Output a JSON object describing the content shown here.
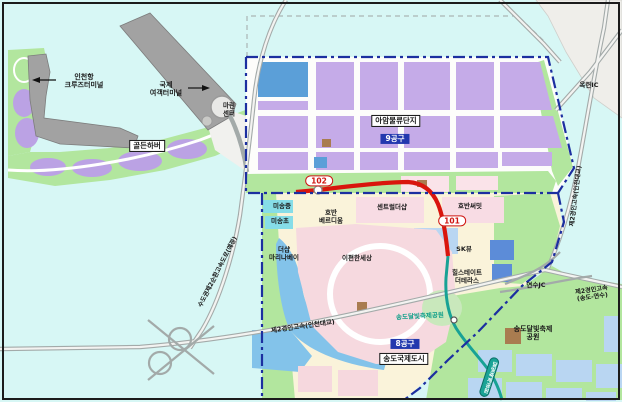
{
  "map_title": "송도국제도시 일대 안내도",
  "regions": {
    "district9_badge": "9공구",
    "district8_badge": "8공구",
    "logistics_complex": "아암물류단지",
    "city_box": "송도국제도시"
  },
  "rail": {
    "station_101": "101",
    "station_102": "102",
    "station_pill": "달빛축제공원",
    "line_color": "#d9150d",
    "subway_color": "#18a295"
  },
  "colors": {
    "water": "#d7f7f5",
    "green_land": "#b2e69e",
    "purple_block": "#c5abe8",
    "blue_block": "#5b9fd8",
    "lightblue_block": "#b9d6f2",
    "pink_block": "#f8dce4",
    "cream_land": "#faf3da",
    "canal": "#83c3ea",
    "boundary_navy": "#1c2fa0",
    "badge_blue": "#2238ae",
    "route_red": "#cf1612",
    "building_gray": "#a2a2a2"
  },
  "labels": [
    {
      "name": "label-incheon-cruise-terminal",
      "text": "인천항\n크루즈터미널",
      "x": 84,
      "y": 81,
      "cls": "plain"
    },
    {
      "name": "label-intl-passenger-terminal",
      "text": "국제\n여객터미널",
      "x": 166,
      "y": 89,
      "cls": "plain"
    },
    {
      "name": "label-marine-center",
      "text": "마린\n센터",
      "x": 229,
      "y": 110,
      "cls": "small"
    },
    {
      "name": "label-golden-harbor",
      "text": "골든하버",
      "x": 147,
      "y": 146,
      "cls": "box"
    },
    {
      "name": "label-aam-logistics-complex",
      "text": "아암물류단지",
      "x": 396,
      "y": 121,
      "cls": "box"
    },
    {
      "name": "badge-district-9",
      "text": "9공구",
      "x": 395,
      "y": 139,
      "cls": "badge-blue"
    },
    {
      "name": "badge-station-102",
      "text": "102",
      "x": 319,
      "y": 181,
      "cls": "route"
    },
    {
      "name": "badge-station-101",
      "text": "101",
      "x": 452,
      "y": 221,
      "cls": "route"
    },
    {
      "name": "label-okryeon-ic",
      "text": "옥련IC",
      "x": 589,
      "y": 86,
      "cls": "small"
    },
    {
      "name": "label-expwy-incheon-bridge-vertical",
      "text": "제2경인고속(인천대교)",
      "x": 576,
      "y": 196,
      "cls": "tiny",
      "rot": -83
    },
    {
      "name": "label-misong-middle-school",
      "text": "미송중",
      "x": 282,
      "y": 207,
      "cls": "small"
    },
    {
      "name": "label-misong-elementary-school",
      "text": "미송초",
      "x": 280,
      "y": 222,
      "cls": "small"
    },
    {
      "name": "label-hoban-verdium",
      "text": "호반\n베르디움",
      "x": 331,
      "y": 217,
      "cls": "small"
    },
    {
      "name": "label-central-thesharp",
      "text": "센트럴더샵",
      "x": 392,
      "y": 208,
      "cls": "small"
    },
    {
      "name": "label-hoban-summit",
      "text": "호반써밋",
      "x": 470,
      "y": 207,
      "cls": "small"
    },
    {
      "name": "label-sk-view",
      "text": "SK뷰",
      "x": 464,
      "y": 250,
      "cls": "small"
    },
    {
      "name": "label-thesharp-marina-bay",
      "text": "더샵\n마리나베이",
      "x": 284,
      "y": 254,
      "cls": "small"
    },
    {
      "name": "label-epyeonhan-sesang",
      "text": "이편한세상",
      "x": 357,
      "y": 259,
      "cls": "small"
    },
    {
      "name": "label-hillstate-the-terrace",
      "text": "힐스테이트\n더테라스",
      "x": 467,
      "y": 277,
      "cls": "small"
    },
    {
      "name": "label-yeonsu-jc",
      "text": "연수JC",
      "x": 536,
      "y": 286,
      "cls": "small"
    },
    {
      "name": "label-expwy-songdo-yeonsu",
      "text": "제2경인고속\n(송도-연수)",
      "x": 592,
      "y": 294,
      "cls": "tiny",
      "rot": -8
    },
    {
      "name": "label-expwy-incheon-bridge",
      "text": "제2경인고속(인천대교)",
      "x": 303,
      "y": 327,
      "cls": "small",
      "rot": -8
    },
    {
      "name": "label-songdo-moonlight-park-road",
      "text": "송도달빛축제공원",
      "x": 420,
      "y": 317,
      "cls": "green",
      "rot": -3
    },
    {
      "name": "badge-district-8",
      "text": "8공구",
      "x": 405,
      "y": 344,
      "cls": "badge-blue"
    },
    {
      "name": "label-songdo-international-city",
      "text": "송도국제도시",
      "x": 404,
      "y": 359,
      "cls": "box"
    },
    {
      "name": "label-songdo-moonlight-festival-park",
      "text": "송도달빛축제\n공원",
      "x": 533,
      "y": 333,
      "cls": "plain"
    },
    {
      "name": "label-expwy-2nd-ring-planned",
      "text": "수도권제2순환고속도로(예정)",
      "x": 218,
      "y": 272,
      "cls": "tiny",
      "rot": -63
    },
    {
      "name": "station-pill-moonlight-park",
      "text": "달빛축제공원",
      "x": 489,
      "y": 377,
      "cls": "pill",
      "rot": 18
    }
  ]
}
